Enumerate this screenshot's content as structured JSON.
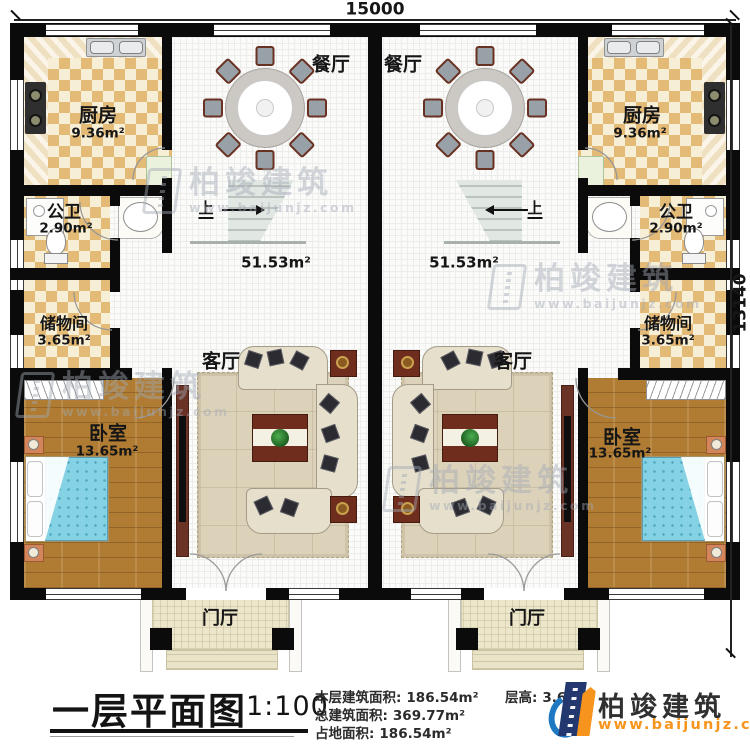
{
  "dimensions": {
    "top_width_mm": "15000",
    "right_height_mm": "13140"
  },
  "rooms": {
    "dining": "餐厅",
    "kitchen": "厨房",
    "kitchen_area": "9.36m²",
    "bath": "公卫",
    "bath_area": "2.90m²",
    "storage": "储物间",
    "storage_area": "3.65m²",
    "bedroom": "卧室",
    "bedroom_area": "13.65m²",
    "living": "客厅",
    "hall_area": "51.53m²",
    "foyer": "门厅",
    "stairs_up": "上"
  },
  "title_block": {
    "plan_title": "一层平面图",
    "scale": "1:100",
    "stats": [
      {
        "label": "本层建筑面积:",
        "value": "186.54m²"
      },
      {
        "label": "总建筑面积:",
        "value": "369.77m²"
      },
      {
        "label": "占地面积:",
        "value": "186.54m²"
      }
    ],
    "floor_height": {
      "label": "层高:",
      "value": "3.6m"
    }
  },
  "brand": {
    "name": "柏竣建筑",
    "url": "www.baijunjz.com"
  },
  "watermark": {
    "name": "柏竣建筑",
    "url": "www.baijunjz.com"
  },
  "colors": {
    "accent_orange": "#f7941d",
    "brand_navy": "#23386e",
    "brand_blue": "#1e79c2",
    "wall": "#0b0b0b"
  }
}
